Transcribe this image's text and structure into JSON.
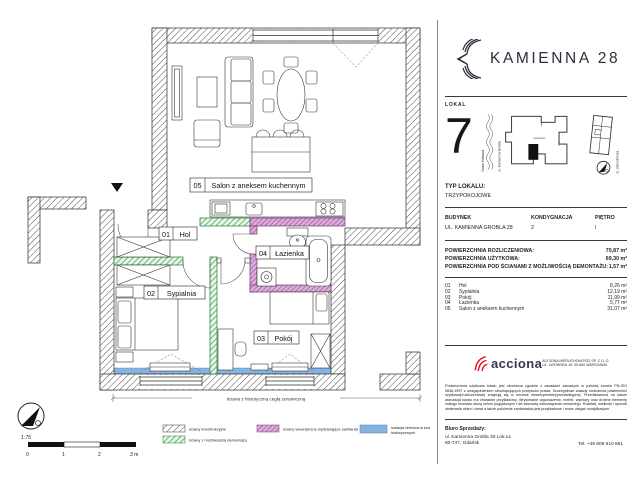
{
  "brand": {
    "name": "KAMIENNA 28"
  },
  "unit": {
    "lokal_label": "LOKAL",
    "number": "7",
    "type_label": "TYP LOKALU:",
    "type_value": "TRZYPOKOJOWE"
  },
  "site": {
    "river": "Nowa Motława",
    "street_main": "ul. Kamienna Grobla",
    "street_side": "ul. Jałmużnicza"
  },
  "building": {
    "label": "BUDYNEK",
    "value": "UL. KAMIENNA GROBLA 28",
    "storey_label": "KONDYGNACJA",
    "storey_value": "2",
    "floor_label": "PIĘTRO",
    "floor_value": "I"
  },
  "areas": [
    {
      "label": "POWIERZCHNIA ROZLICZENIOWA:",
      "value": "70,87 m²"
    },
    {
      "label": "POWIERZCHNIA UŻYTKOWA:",
      "value": "69,30 m²"
    },
    {
      "label": "POWIERZCHNIA POD ŚCIANAMI Z MOŻLIWOŚCIĄ DEMONTAŻU:",
      "value": "1,57 m²"
    }
  ],
  "rooms": [
    {
      "no": "01",
      "name": "Hol",
      "area": "8,26 m²"
    },
    {
      "no": "02",
      "name": "Sypialnia",
      "area": "12,19 m²"
    },
    {
      "no": "03",
      "name": "Pokój",
      "area": "11,99 m²"
    },
    {
      "no": "04",
      "name": "Łazienka",
      "area": "5,77 m²"
    },
    {
      "no": "05",
      "name": "Salon z aneksem kuchennym",
      "area": "31,07 m²"
    }
  ],
  "plan": {
    "note_bottom": "ściana z historyczną cegłą ceramiczną",
    "scale": "1:75",
    "scale_ticks": [
      "0",
      "1",
      "2",
      "3 m"
    ]
  },
  "legend": [
    {
      "label": "ściany konstrukcyjne"
    },
    {
      "label": "ściany z możliwością demontażu"
    },
    {
      "label": "ściany wewnętrzne wydzielające sanitariat"
    },
    {
      "label": "izolacja termiczna ścian",
      "label2": "historycznych"
    }
  ],
  "developer": {
    "logo": "acciona",
    "company_line1": "ACCIONA NIERUCHOMOŚCI SP. Z O. O.",
    "company_line2": "UL. LWOWSKA 19, 00-660 WARSZAWA",
    "disclaimer": "Powierzchnia użytkowa lokalu jest określona zgodnie z zasadami zawartymi w polskiej normie PN-ISO 9836:1997 z uwzględnieniem obowiązujących przepisów prawa. Szczegółowe zasady rozliczenia powierzchni użytkowej/rozliczeniowej znajdują się w umowie deweloperskiej/przedwstępnej. Przedstawiona na karcie aranżacja lokalu ma charakter przykładowy. Wrysowane wyposażenie, meble, wymiary oraz drobne elementy małego montażu służą celom poglądowym i nie stanowią zobowiązania umownego. Rozkład, wielkość i sposób otwierania okien i drzwi a także położenie sanitariatów jest przykładowe i może ulegać modyfikacjom."
  },
  "sales": {
    "label": "Biuro Sprzedaży:",
    "address1": "ul. Kamienna Grobla 30 Lok.u1",
    "address2": "80-747, Gdańsk",
    "phone": "Tel. +48 609 610 851"
  },
  "colors": {
    "wall_green": "#2f9e44",
    "wall_purple": "#a05aa0",
    "insulation_blue": "#85b4e0",
    "accent_red": "#e30613",
    "ink": "#2a2f3c"
  }
}
